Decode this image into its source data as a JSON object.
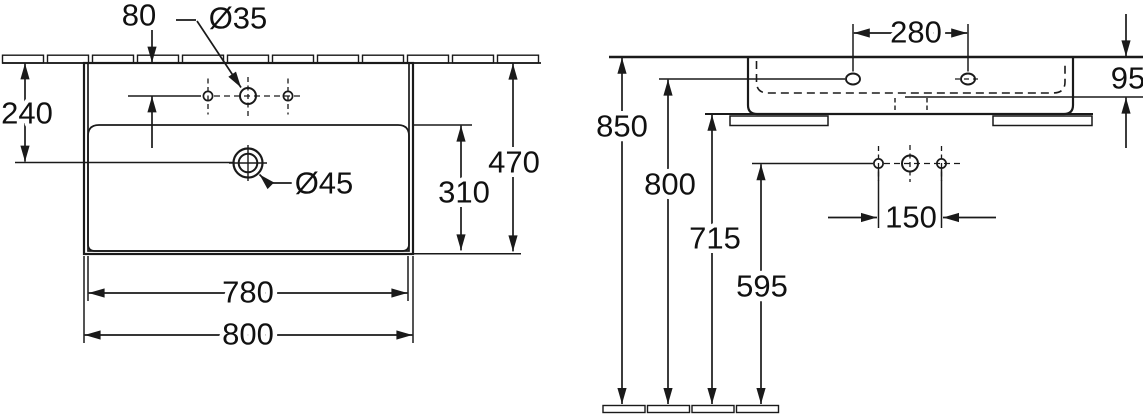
{
  "drawing": {
    "type": "washbasin installation drawing",
    "units": "mm",
    "colors": {
      "line": "#1a1a1a",
      "background": "#ffffff"
    },
    "plan": {
      "tap_hole_setback": "80",
      "tap_hole_diameter": "Ø35",
      "drain_center_offset": "240",
      "overall_depth": "470",
      "bowl_depth": "310",
      "bowl_width": "780",
      "overall_width": "800",
      "drain_diameter": "Ø45"
    },
    "elevation": {
      "fixing_hole_spacing": "280",
      "front_height": "95",
      "rim_height": "850",
      "fixing_hole_height": "800",
      "underside_height": "715",
      "supply_height": "595",
      "supply_spacing": "150"
    }
  }
}
